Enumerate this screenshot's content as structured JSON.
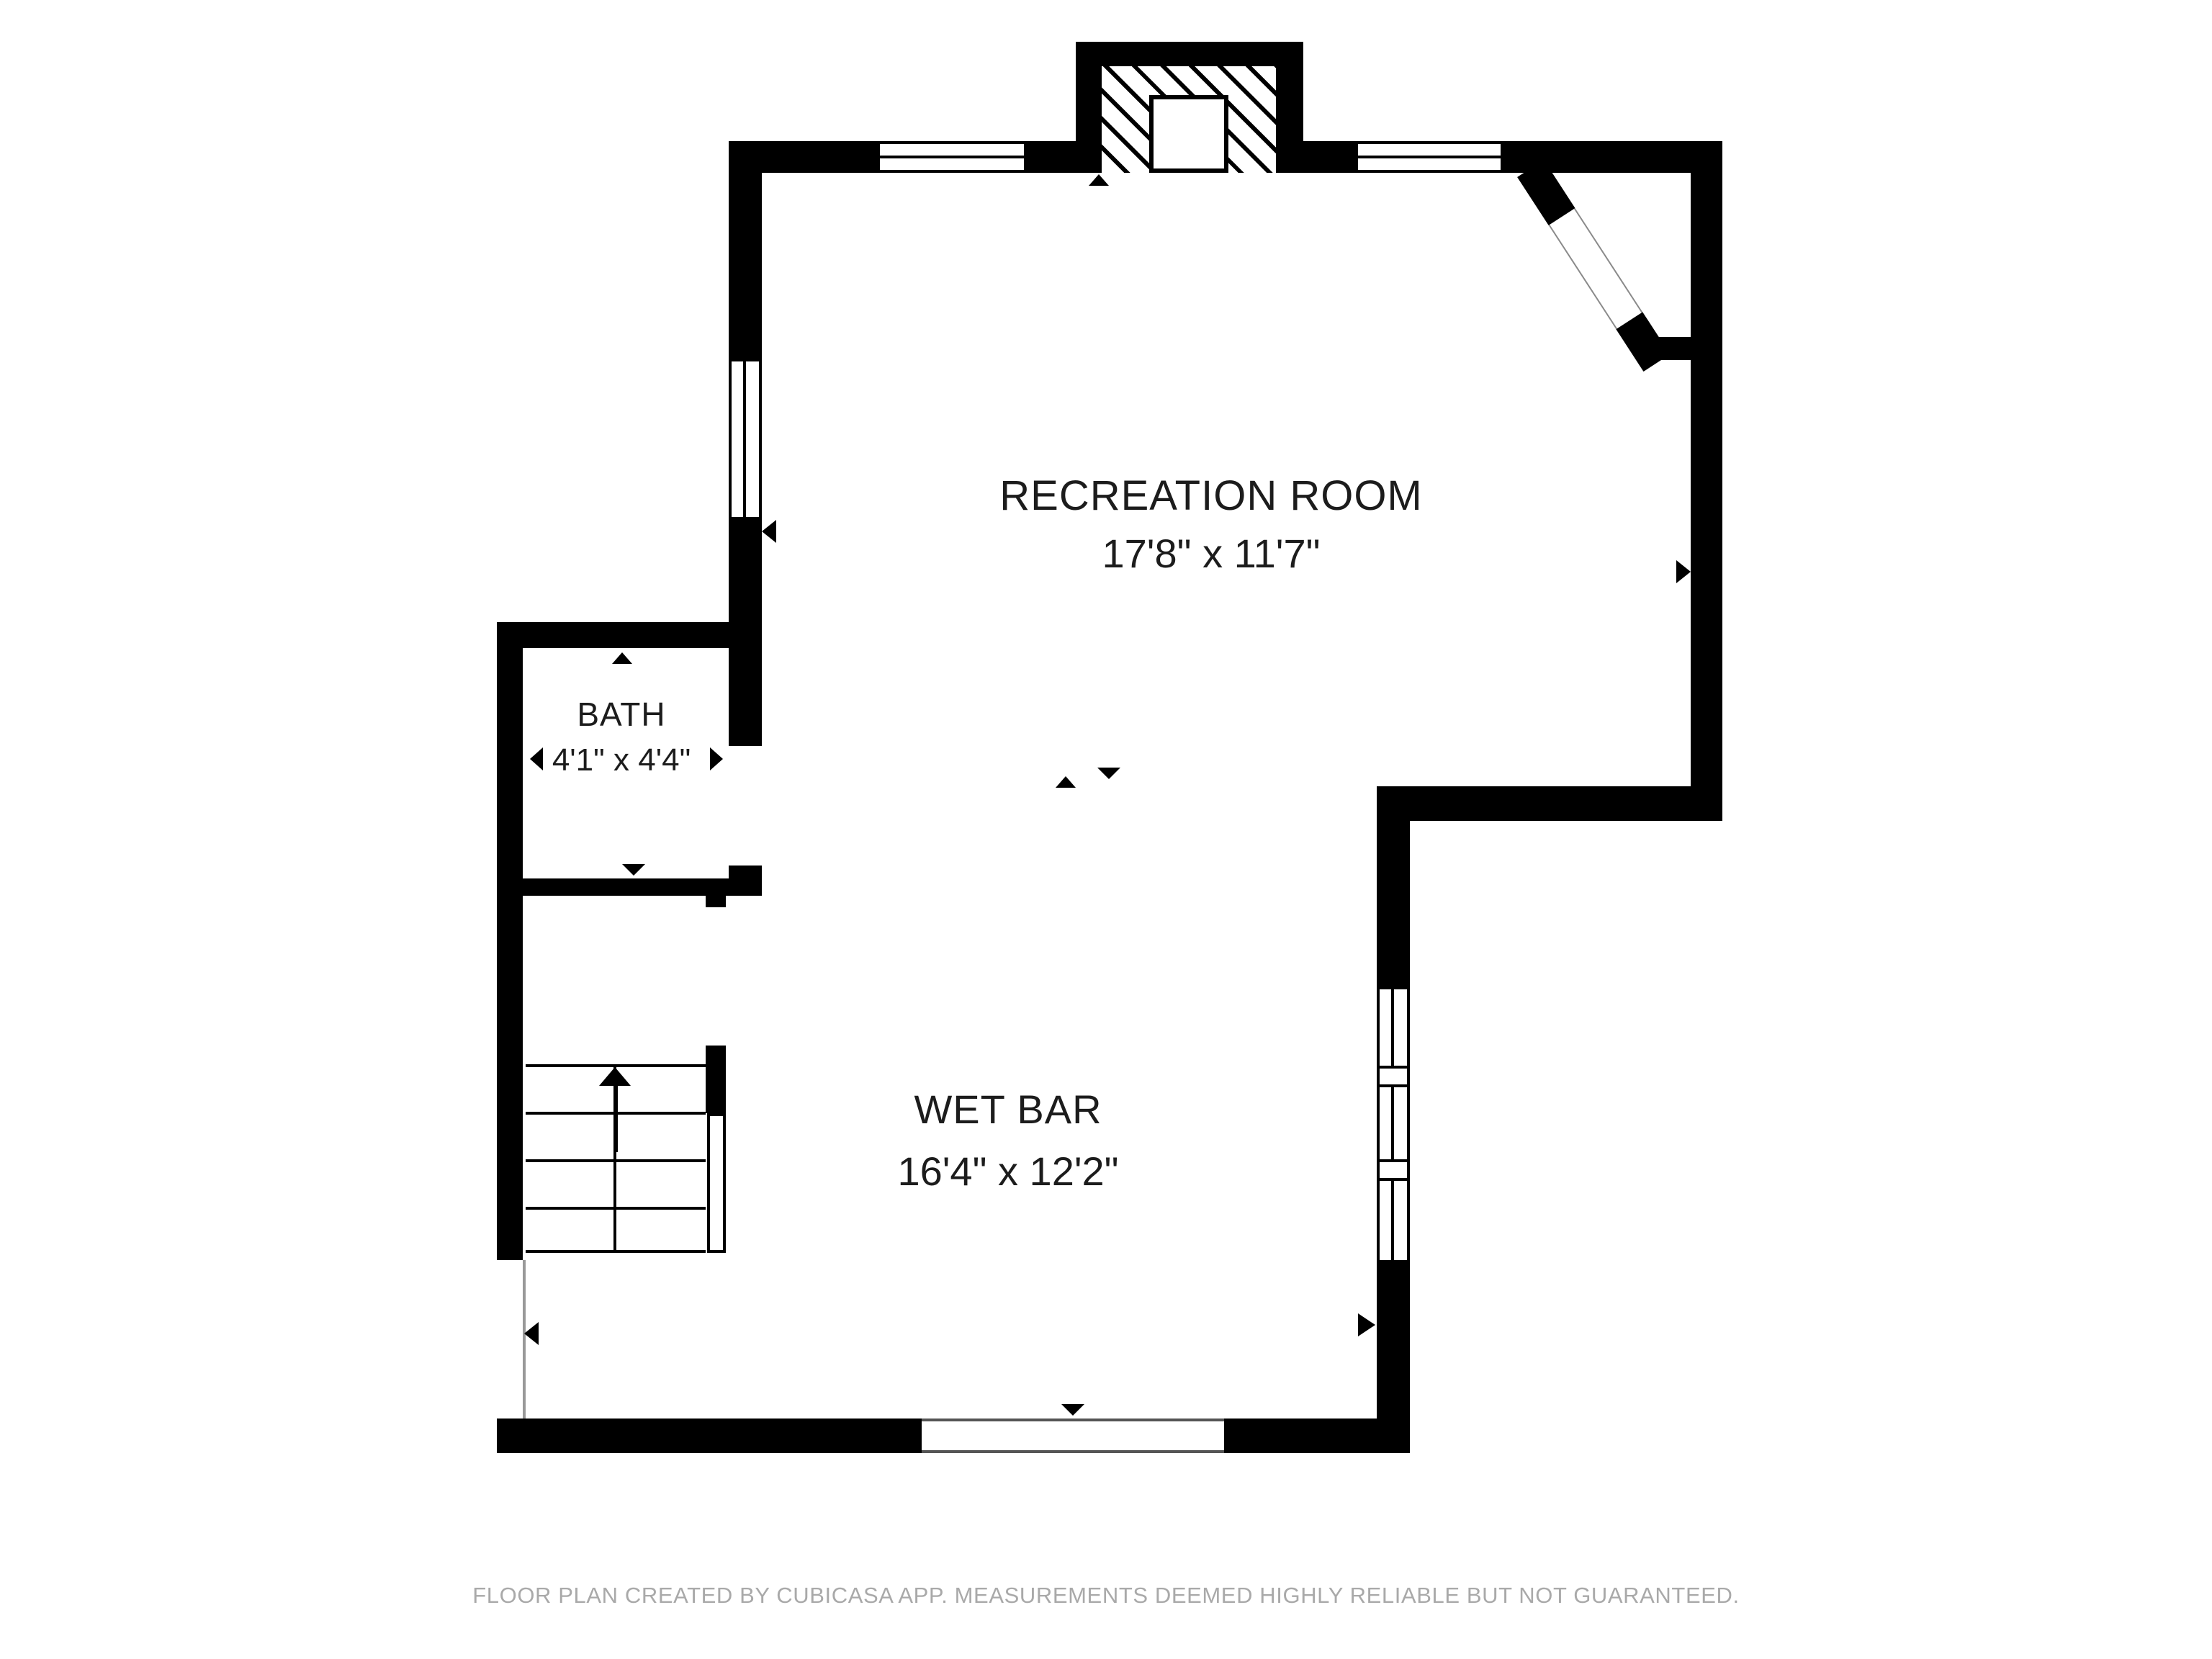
{
  "colors": {
    "wall": "#000000",
    "text": "#1c1c1c",
    "footer": "#a9a9a9",
    "line": "#8a8a8a"
  },
  "rooms": {
    "recreation": {
      "name": "RECREATION ROOM",
      "dimensions": "17'8\" x 11'7\""
    },
    "bath": {
      "name": "BATH",
      "dimensions": "4'1\" x 4'4\""
    },
    "wetbar": {
      "name": "WET BAR",
      "dimensions": "16'4\" x 12'2\""
    }
  },
  "footer": {
    "text": "FLOOR PLAN CREATED BY CUBICASA APP. MEASUREMENTS DEEMED HIGHLY RELIABLE BUT NOT GUARANTEED."
  }
}
